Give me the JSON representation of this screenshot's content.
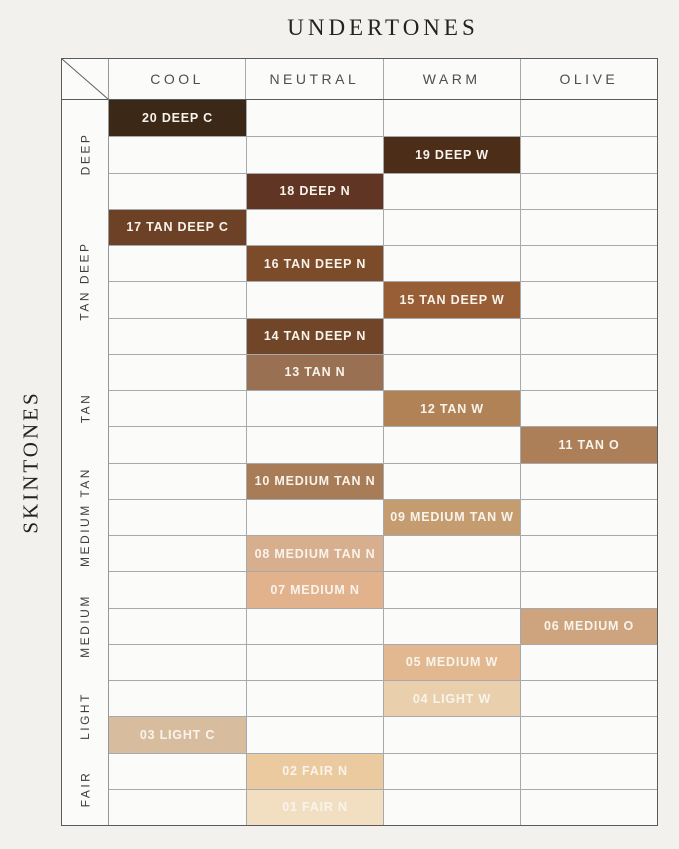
{
  "title": "UNDERTONES",
  "side_title": "SKINTONES",
  "colors": {
    "page_bg": "#f3f1ee",
    "cell_bg": "#fbfbf9",
    "outer_line": "#595b5d",
    "inner_line": "#a7aaac",
    "label_col_line": "#95989b",
    "header_text": "#4e4e4e",
    "group_label_text": "#3d3d3d",
    "cell_label_text": "#f8f4ec"
  },
  "chart_data": {
    "type": "table",
    "title": "UNDERTONES",
    "row_axis_label": "SKINTONES",
    "columns": [
      "COOL",
      "NEUTRAL",
      "WARM",
      "OLIVE"
    ],
    "row_groups": [
      {
        "label": "DEEP",
        "row_count": 3
      },
      {
        "label": "TAN DEEP",
        "row_count": 4
      },
      {
        "label": "TAN",
        "row_count": 3
      },
      {
        "label": "MEDIUM TAN",
        "row_count": 3
      },
      {
        "label": "MEDIUM",
        "row_count": 3
      },
      {
        "label": "LIGHT",
        "row_count": 2
      },
      {
        "label": "FAIR",
        "row_count": 2
      }
    ],
    "rows": [
      {
        "shade": "20 DEEP C",
        "undertone": "COOL",
        "skintone_group": "DEEP",
        "swatch_color": "#3b2817"
      },
      {
        "shade": "19 DEEP W",
        "undertone": "WARM",
        "skintone_group": "DEEP",
        "swatch_color": "#4b2d18"
      },
      {
        "shade": "18 DEEP N",
        "undertone": "NEUTRAL",
        "skintone_group": "DEEP",
        "swatch_color": "#603523"
      },
      {
        "shade": "17 TAN DEEP C",
        "undertone": "COOL",
        "skintone_group": "TAN DEEP",
        "swatch_color": "#6c4126"
      },
      {
        "shade": "16 TAN DEEP N",
        "undertone": "NEUTRAL",
        "skintone_group": "TAN DEEP",
        "swatch_color": "#7c4b2a"
      },
      {
        "shade": "15 TAN DEEP W",
        "undertone": "WARM",
        "skintone_group": "TAN DEEP",
        "swatch_color": "#985f36"
      },
      {
        "shade": "14 TAN DEEP N",
        "undertone": "NEUTRAL",
        "skintone_group": "TAN DEEP",
        "swatch_color": "#714628"
      },
      {
        "shade": "13 TAN N",
        "undertone": "NEUTRAL",
        "skintone_group": "TAN",
        "swatch_color": "#9a7053"
      },
      {
        "shade": "12 TAN W",
        "undertone": "WARM",
        "skintone_group": "TAN",
        "swatch_color": "#b18256"
      },
      {
        "shade": "11 TAN O",
        "undertone": "OLIVE",
        "skintone_group": "TAN",
        "swatch_color": "#ac7f58"
      },
      {
        "shade": "10 MEDIUM TAN N",
        "undertone": "NEUTRAL",
        "skintone_group": "MEDIUM TAN",
        "swatch_color": "#a97c58"
      },
      {
        "shade": "09 MEDIUM TAN W",
        "undertone": "WARM",
        "skintone_group": "MEDIUM TAN",
        "swatch_color": "#c59c70"
      },
      {
        "shade": "08 MEDIUM TAN N",
        "undertone": "NEUTRAL",
        "skintone_group": "MEDIUM TAN",
        "swatch_color": "#d7ae8e"
      },
      {
        "shade": "07 MEDIUM N",
        "undertone": "NEUTRAL",
        "skintone_group": "MEDIUM",
        "swatch_color": "#e2b28c"
      },
      {
        "shade": "06 MEDIUM O",
        "undertone": "OLIVE",
        "skintone_group": "MEDIUM",
        "swatch_color": "#cda47e"
      },
      {
        "shade": "05 MEDIUM W",
        "undertone": "WARM",
        "skintone_group": "MEDIUM",
        "swatch_color": "#e2b891"
      },
      {
        "shade": "04 LIGHT W",
        "undertone": "WARM",
        "skintone_group": "LIGHT",
        "swatch_color": "#e9cfac"
      },
      {
        "shade": "03 LIGHT C",
        "undertone": "COOL",
        "skintone_group": "LIGHT",
        "swatch_color": "#d8bc9e"
      },
      {
        "shade": "02 FAIR N",
        "undertone": "NEUTRAL",
        "skintone_group": "FAIR",
        "swatch_color": "#ecca9f"
      },
      {
        "shade": "01 FAIR N",
        "undertone": "NEUTRAL",
        "skintone_group": "FAIR",
        "swatch_color": "#f2dfc2"
      }
    ]
  }
}
